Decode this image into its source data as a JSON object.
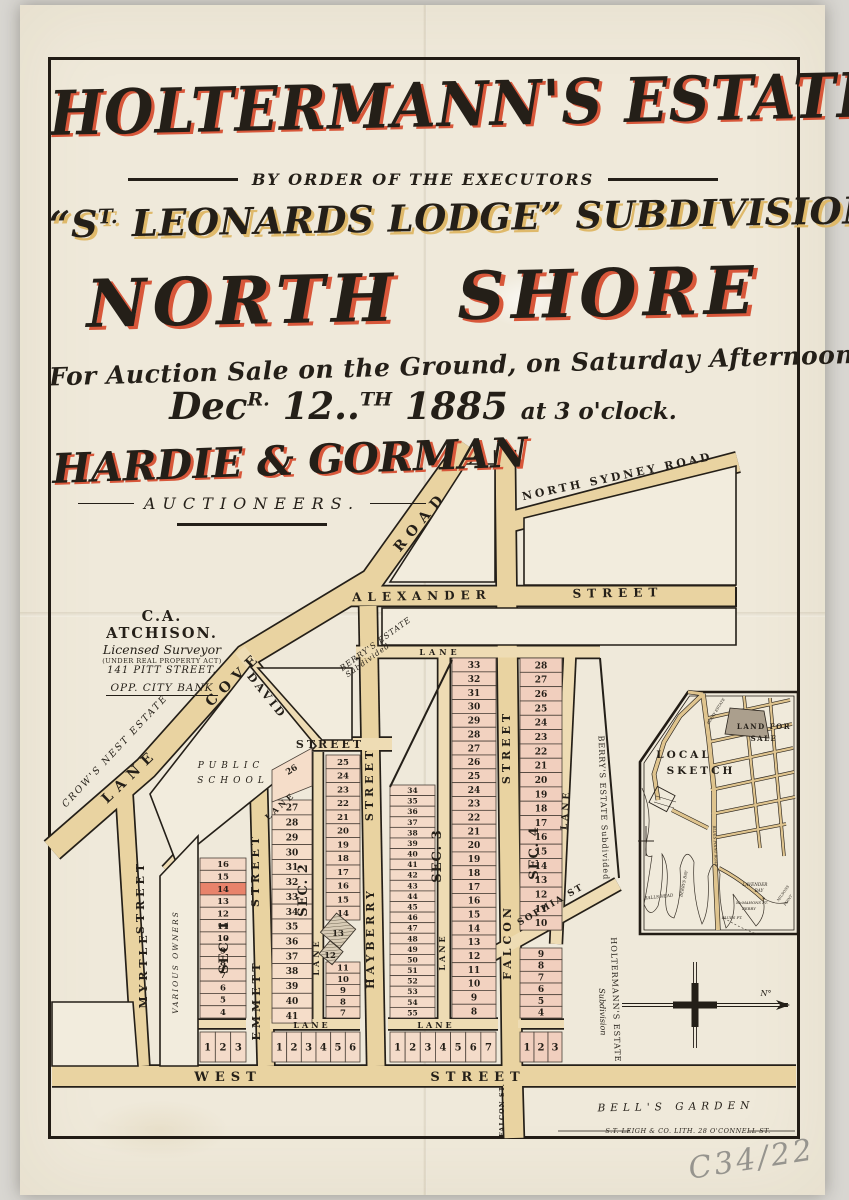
{
  "palette": {
    "ink": "#241f18",
    "accent_red": "#d8573a",
    "gold": "#dfb96a",
    "paper": "#efe9da",
    "road_tan": "#e9d3a1",
    "lane_tan": "#eedcb4",
    "block_white": "#f2ecdd",
    "lot_pink": "#f3d6c3",
    "red_lot": "#e8836b",
    "hatch_fill": "#d8ccb6"
  },
  "poster": {
    "title": "HOLTERMANN'S ESTATE",
    "order_line": "BY ORDER OF THE EXECUTORS",
    "sub_pre": "“S",
    "sub_sup": "T.",
    "sub_rest": "LEONARDS LODGE” SUBDIVISION",
    "region_w1": "NORTH",
    "region_w2": "SHORE",
    "sale_line": "For Auction Sale on the Ground, on Saturday Afternoon",
    "d_dec": "Dec",
    "d_r": "R.",
    "d_12": "12..",
    "d_th": "TH",
    "d_year": "1885",
    "d_time": "at 3 o'clock.",
    "auctioneer": "HARDIE & GORMAN",
    "auctioneer_role": "AUCTIONEERS."
  },
  "surveyor": {
    "name": "C.A. ATCHISON.",
    "line1": "Licensed Surveyor",
    "line2": "(UNDER REAL PROPERTY ACT)",
    "line3": "141 PITT STREET.",
    "line4": "OPP. CITY BANK"
  },
  "map": {
    "labels": [
      {
        "t": "ROAD",
        "x": 424,
        "y": 524,
        "r": -50,
        "s": 14,
        "sp": 7
      },
      {
        "t": "NORTH SYDNEY ROAD",
        "x": 618,
        "y": 480,
        "r": -12,
        "s": 11,
        "sp": 3
      },
      {
        "t": "ALEXANDER",
        "x": 422,
        "y": 600,
        "r": -1,
        "s": 12,
        "sp": 6
      },
      {
        "t": "STREET",
        "x": 618,
        "y": 597,
        "r": -1,
        "s": 12,
        "sp": 6
      },
      {
        "t": "COVE",
        "x": 237,
        "y": 682,
        "r": -44,
        "s": 14,
        "sp": 7
      },
      {
        "t": "LANE",
        "x": 133,
        "y": 779,
        "r": -44,
        "s": 14,
        "sp": 7
      },
      {
        "t": "LANE",
        "x": 440,
        "y": 655,
        "r": 0,
        "s": 8,
        "sp": 4
      },
      {
        "t": "DAVID",
        "x": 264,
        "y": 698,
        "r": 51,
        "s": 11,
        "sp": 3
      },
      {
        "t": "STREET",
        "x": 330,
        "y": 748,
        "r": 0,
        "s": 11,
        "sp": 3
      },
      {
        "t": "LANE",
        "x": 282,
        "y": 808,
        "r": -42,
        "s": 8,
        "sp": 3
      },
      {
        "t": "STREET",
        "x": 144,
        "y": 897,
        "r": -90,
        "s": 11,
        "sp": 4
      },
      {
        "t": "MYRTLE",
        "x": 147,
        "y": 970,
        "r": -90,
        "s": 11,
        "sp": 4
      },
      {
        "t": "STREET",
        "x": 259,
        "y": 870,
        "r": -90,
        "s": 11,
        "sp": 4
      },
      {
        "t": "EMMETT",
        "x": 260,
        "y": 1000,
        "r": -90,
        "s": 11,
        "sp": 4
      },
      {
        "t": "STREET",
        "x": 373,
        "y": 784,
        "r": -90,
        "s": 11,
        "sp": 4
      },
      {
        "t": "HAYBERRY",
        "x": 374,
        "y": 938,
        "r": -90,
        "s": 11,
        "sp": 4
      },
      {
        "t": "STREET",
        "x": 510,
        "y": 747,
        "r": -90,
        "s": 11,
        "sp": 4
      },
      {
        "t": "FALCON",
        "x": 511,
        "y": 942,
        "r": -90,
        "s": 11,
        "sp": 4
      },
      {
        "t": "LANE",
        "x": 319,
        "y": 957,
        "r": -90,
        "s": 8,
        "sp": 3
      },
      {
        "t": "LANE",
        "x": 445,
        "y": 952,
        "r": -90,
        "s": 8,
        "sp": 3
      },
      {
        "t": "LANE",
        "x": 568,
        "y": 810,
        "r": -86,
        "s": 9,
        "sp": 3
      },
      {
        "t": "LANE",
        "x": 312,
        "y": 1028,
        "r": 0,
        "s": 8,
        "sp": 3
      },
      {
        "t": "LANE",
        "x": 436,
        "y": 1028,
        "r": 0,
        "s": 8,
        "sp": 3
      },
      {
        "t": "SOPHIA ST",
        "x": 552,
        "y": 907,
        "r": -30,
        "s": 9,
        "sp": 2
      },
      {
        "t": "WEST",
        "x": 228,
        "y": 1081,
        "r": 0,
        "s": 13,
        "sp": 6
      },
      {
        "t": "STREET",
        "x": 478,
        "y": 1081,
        "r": 0,
        "s": 13,
        "sp": 6
      },
      {
        "t": "FALCON ST.",
        "x": 504,
        "y": 1110,
        "r": -90,
        "s": 6.5,
        "sp": 1
      },
      {
        "t": "CROW'S NEST ESTATE",
        "x": 117,
        "y": 753,
        "r": -47,
        "s": 9.5,
        "sp": 2,
        "i": 1,
        "w": "n"
      },
      {
        "t": "PUBLIC",
        "x": 231,
        "y": 768,
        "r": 0,
        "s": 9,
        "sp": 5,
        "i": 1,
        "w": "n"
      },
      {
        "t": "SCHOOL",
        "x": 233,
        "y": 783,
        "r": 0,
        "s": 9,
        "sp": 5,
        "i": 1,
        "w": "n"
      },
      {
        "t": "VARIOUS OWNERS",
        "x": 178,
        "y": 962,
        "r": -90,
        "s": 7.5,
        "sp": 2,
        "i": 1,
        "w": "n"
      },
      {
        "t": "BERRY'S ESTATE",
        "x": 377,
        "y": 646,
        "r": -36,
        "s": 8,
        "sp": 1,
        "i": 1,
        "w": "n"
      },
      {
        "t": "Subdivided",
        "x": 369,
        "y": 662,
        "r": -36,
        "s": 7.5,
        "sp": 1,
        "i": 1,
        "w": "n"
      },
      {
        "t": "BERRY'S ESTATE Subdivided",
        "x": 601,
        "y": 808,
        "r": 88,
        "s": 8,
        "sp": 1,
        "w": "n"
      },
      {
        "t": "HOLTERMANN'S ESTATE",
        "x": 613,
        "y": 1000,
        "r": 88,
        "s": 8,
        "sp": 1,
        "w": "n"
      },
      {
        "t": "Subdivision",
        "x": 600,
        "y": 1012,
        "r": 88,
        "s": 8,
        "i": 1,
        "w": "n"
      },
      {
        "t": "SEC. 1",
        "x": 228,
        "y": 947,
        "r": -90,
        "s": 13,
        "sp": 1
      },
      {
        "t": "SEC. 2",
        "x": 307,
        "y": 890,
        "r": -90,
        "s": 13,
        "sp": 1
      },
      {
        "t": "SEC. 3",
        "x": 441,
        "y": 856,
        "r": -90,
        "s": 13,
        "sp": 1
      },
      {
        "t": "SEC. 4",
        "x": 538,
        "y": 853,
        "r": -90,
        "s": 13,
        "sp": 1
      },
      {
        "t": "BELL'S GARDEN",
        "x": 676,
        "y": 1110,
        "r": -1,
        "s": 10.5,
        "sp": 5,
        "i": 1,
        "w": "n"
      },
      {
        "t": "S.T. LEIGH & CO. LITH. 28 O'CONNELL ST.",
        "x": 688,
        "y": 1133,
        "r": 0,
        "s": 6.5,
        "sp": 0.5,
        "i": 1,
        "w": "n"
      }
    ],
    "lot_columns": [
      {
        "x": 200,
        "w": 46,
        "y": 858,
        "h": 12.31,
        "fs": 8.5,
        "fill": "#f3d8c6",
        "nums": [
          16,
          15,
          14,
          13,
          12,
          11,
          10,
          9,
          8,
          7,
          6,
          5,
          4
        ],
        "red": [
          14
        ]
      },
      {
        "x": 272,
        "w": 40,
        "y": 800,
        "h": 14.87,
        "fs": 9,
        "fill": "#f5ddc9",
        "nums": [
          27,
          28,
          29,
          30,
          31,
          32,
          33,
          34,
          35,
          36,
          37,
          38,
          39,
          40,
          41
        ]
      },
      {
        "x": 326,
        "w": 34,
        "y": 755,
        "h": 13.75,
        "fs": 8.5,
        "fill": "#f3d6c2",
        "nums": [
          25,
          24,
          23,
          22,
          21,
          20,
          19,
          18,
          17,
          16,
          15,
          14
        ]
      },
      {
        "x": 326,
        "w": 34,
        "y": 962,
        "h": 11.2,
        "fs": 8.5,
        "fill": "#f3d6c2",
        "nums": [
          11,
          10,
          9,
          8,
          7
        ]
      },
      {
        "x": 390,
        "w": 45,
        "y": 785,
        "h": 10.59,
        "fs": 7.5,
        "fill": "#f4dac8",
        "nums": [
          34,
          35,
          36,
          37,
          38,
          39,
          40,
          41,
          42,
          43,
          44,
          45,
          46,
          47,
          48,
          49,
          50,
          51,
          52,
          53,
          54,
          55
        ]
      },
      {
        "x": 452,
        "w": 44,
        "y": 658,
        "h": 13.85,
        "fs": 9,
        "fill": "#f2d2c0",
        "nums": [
          33,
          32,
          31,
          30,
          29,
          28,
          27,
          26,
          25,
          24,
          23,
          22,
          21,
          20,
          19,
          18,
          17,
          16,
          15,
          14,
          13,
          12,
          11,
          10,
          9,
          8
        ]
      },
      {
        "x": 520,
        "w": 42,
        "y": 658,
        "h": 14.32,
        "fs": 9,
        "fill": "#f1cfbe",
        "nums": [
          28,
          27,
          26,
          25,
          24,
          23,
          22,
          21,
          20,
          19,
          18,
          17,
          16,
          15,
          14,
          13,
          12,
          11,
          10
        ]
      },
      {
        "x": 520,
        "w": 42,
        "y": 948,
        "h": 11.67,
        "fs": 9,
        "fill": "#f1cfbe",
        "nums": [
          9,
          8,
          7,
          6,
          5,
          4
        ]
      }
    ],
    "lot_rows": [
      {
        "x": 200,
        "w": 46,
        "y": 1032,
        "h": 30,
        "fs": 10,
        "fill": "#f4dbc9",
        "nums": [
          1,
          2,
          3
        ]
      },
      {
        "x": 272,
        "w": 88,
        "y": 1032,
        "h": 30,
        "fs": 10,
        "fill": "#f4dbc9",
        "nums": [
          1,
          2,
          3,
          4,
          5,
          6
        ]
      },
      {
        "x": 390,
        "w": 106,
        "y": 1032,
        "h": 30,
        "fs": 10,
        "fill": "#f4dbc9",
        "nums": [
          1,
          2,
          3,
          4,
          5,
          6,
          7
        ]
      },
      {
        "x": 520,
        "w": 42,
        "y": 1032,
        "h": 30,
        "fs": 10,
        "fill": "#f1cfbe",
        "nums": [
          1,
          2,
          3
        ]
      }
    ],
    "extra_lots": [
      {
        "n": "26",
        "x": 293,
        "y": 772,
        "r": -32
      },
      {
        "n": "13",
        "x": 338,
        "y": 936,
        "r": 0
      },
      {
        "n": "12",
        "x": 330,
        "y": 958,
        "r": 0
      }
    ]
  },
  "inset": {
    "labels": [
      {
        "t": "LOCAL",
        "x": 684,
        "y": 758,
        "r": 0,
        "s": 10.5,
        "sp": 3
      },
      {
        "t": "SKETCH",
        "x": 701,
        "y": 774,
        "r": 0,
        "s": 10.5,
        "sp": 3
      },
      {
        "t": "LAND FOR",
        "x": 764,
        "y": 729,
        "r": 0,
        "s": 7,
        "sp": 1.5
      },
      {
        "t": "SALE",
        "x": 764,
        "y": 741,
        "r": 0,
        "s": 7,
        "sp": 1.5
      },
      {
        "t": "BERRY ESTATE",
        "x": 717,
        "y": 712,
        "r": -58,
        "s": 3.8,
        "i": 1,
        "w": "n"
      },
      {
        "t": "BLUES POINT ROAD",
        "x": 714,
        "y": 846,
        "r": 87,
        "s": 3.8,
        "i": 1,
        "w": "n"
      },
      {
        "t": "BALLS HEAD",
        "x": 659,
        "y": 898,
        "r": -6,
        "s": 4.2,
        "i": 1,
        "w": "n"
      },
      {
        "t": "BERRYS BAY",
        "x": 685,
        "y": 884,
        "r": -78,
        "s": 4,
        "i": 1,
        "w": "n"
      },
      {
        "t": "LAVENDER",
        "x": 755,
        "y": 886,
        "r": 0,
        "s": 4.2,
        "i": 1,
        "w": "n"
      },
      {
        "t": "BAY",
        "x": 759,
        "y": 892,
        "r": 0,
        "s": 4.2,
        "i": 1,
        "w": "n"
      },
      {
        "t": "McMAHONS PT.",
        "x": 752,
        "y": 904,
        "r": 0,
        "s": 3.8,
        "i": 1,
        "w": "n"
      },
      {
        "t": "FERRY",
        "x": 749,
        "y": 910,
        "r": 0,
        "s": 3.8,
        "i": 1,
        "w": "n"
      },
      {
        "t": "BLUES PT.",
        "x": 732,
        "y": 919,
        "r": 0,
        "s": 3.8,
        "i": 1,
        "w": "n"
      },
      {
        "t": "MILSONS",
        "x": 784,
        "y": 894,
        "r": -55,
        "s": 3.6,
        "i": 1,
        "w": "n"
      },
      {
        "t": "POINT",
        "x": 789,
        "y": 901,
        "r": -55,
        "s": 3.6,
        "i": 1,
        "w": "n"
      }
    ]
  },
  "compass": {
    "label": "N°"
  },
  "footer": {
    "catalog": "C34/22"
  }
}
